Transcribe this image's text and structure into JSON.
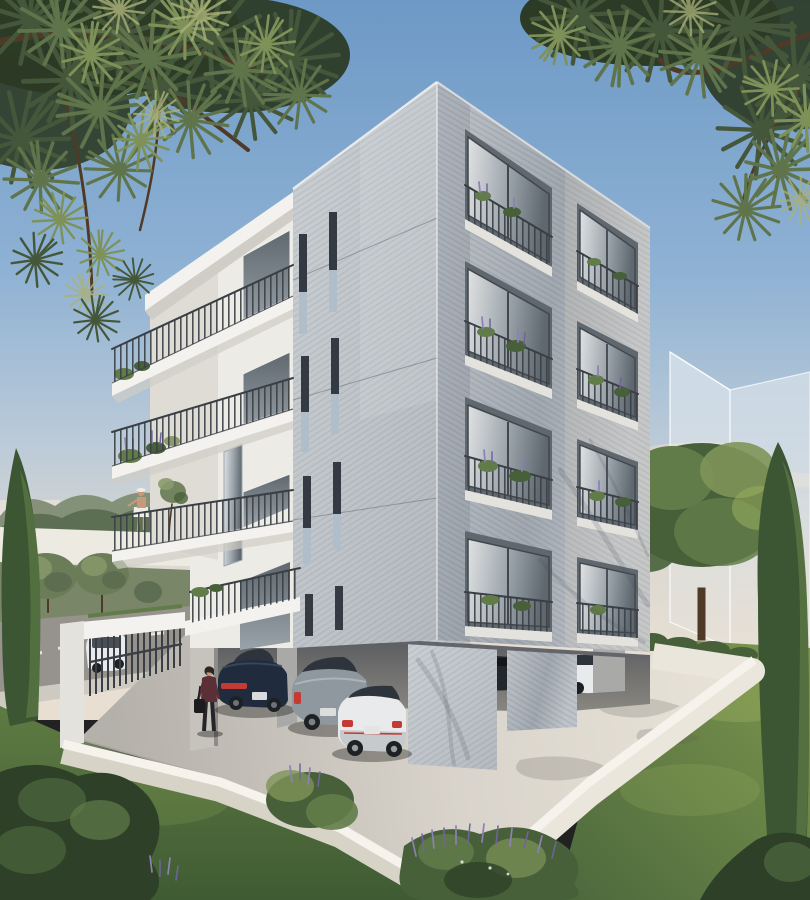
{
  "scene": {
    "title": "Architectural rendering of a modern five-storey concrete apartment building with ground-level parking, framed by pine branches, in late-afternoon light",
    "view": "corner perspective showing two facades",
    "people": [
      "woman walking on the paved path carrying a handbag",
      "woman standing on an upper balcony"
    ],
    "vehicles": [
      "dark navy sedan parked under building",
      "grey SUV parked under building",
      "white hatchback with red trim",
      "dark car deep in garage",
      "white car deep in garage",
      "white SUV on the street behind the fence"
    ],
    "vegetation": [
      "pine branches overhanging top corners",
      "cypress trees",
      "olive trees",
      "lavender shrubs",
      "balcony planters",
      "lawn"
    ],
    "structures": [
      "translucent massing of neighbouring building",
      "white perimeter garden wall",
      "white entrance pergola with slatted gate"
    ]
  },
  "colors": {
    "sky1": "#6D99C6",
    "sky2": "#8FB2D4",
    "sky3": "#BCCBD8",
    "sky4": "#DCD9D2",
    "sky5": "#E8DFD2",
    "cloud": "#F2DEC6",
    "haze": "#E8E4DB",
    "treeline1": "#7A8A6E",
    "treeline2": "#56684C",
    "bgwall": "#EDEAE2",
    "road": "#96938D",
    "roadside": "#CFCAC1",
    "roaddash": "#E8E6E0",
    "hedge": "#7A8668",
    "ghost": "#E9EEF2",
    "ghostedge": "#F8FAFB",
    "concr1": "#C9CED2",
    "concr2": "#B2B8BE",
    "concr3": "#BCC1C7",
    "concr4": "#9EA5AD",
    "strie": "#6A7077",
    "white1": "#F3F2EF",
    "white2": "#E3E2DD",
    "white3": "#CFCDC6",
    "backwall": "#EDEBE5",
    "backwallsh": "#D6D2CA",
    "railing": "#3A3F45",
    "glass1": "#DFE2E3",
    "glass2": "#9AA3AA",
    "glass3": "#5F676F",
    "frame": "#42474D",
    "panel": "#AFBEC9",
    "slit": "#333A41",
    "cavity1": "#55575B",
    "cavity2": "#8A8781",
    "soffit": "#63656A",
    "column1": "#C6C3BC",
    "column2": "#A9A9A7",
    "pav1": "#B4B0AA",
    "pav2": "#D9D4CB",
    "pav3": "#E7E2D7",
    "wallTop": "#F6F3EC",
    "wallFace": "#EAE6DC",
    "wallShade": "#D8D3C7",
    "grass1": "#5F7B43",
    "grass2": "#3F5B33",
    "lawn1": "#7E974F",
    "lawn2": "#4C683C",
    "lawnlight": "#95AA5C",
    "bush1": "#47603A",
    "bush2": "#627C49",
    "bush3": "#7E9458",
    "bushdark": "#2E4128",
    "cypress": "#3C5634",
    "cypresslight": "#68874C",
    "olive1": "#6B7D58",
    "olive2": "#8A9A6B",
    "lavender": "#8C81B4",
    "lavender2": "#6F659B",
    "pine1": "#2C3B26",
    "pine2": "#45573A",
    "pine3": "#5F744A",
    "pine4": "#7E9158",
    "pineglow": "#ABB178",
    "branch": "#4F3A28",
    "carNavy": "#202B3E",
    "carNavyHi": "#3C4D63",
    "tail": "#C43B33",
    "suv": "#8F989E",
    "suvDark": "#5F666B",
    "carWhite": "#E8EAEB",
    "carWhiteSh": "#C6CACD",
    "tyre": "#1E2124",
    "glassCar": "#2E343B",
    "skin": "#C79A7C",
    "sweater": "#5A2F36",
    "pants": "#26262A",
    "hair": "#2E2620",
    "bag": "#1C1C1F",
    "hat": "#EFEDE8"
  }
}
